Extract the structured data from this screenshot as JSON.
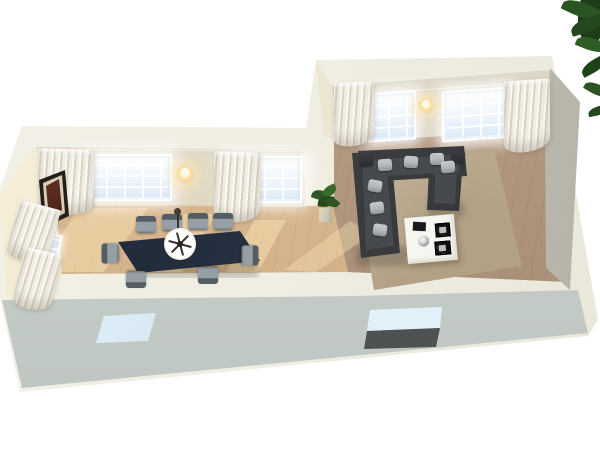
{
  "scene": {
    "type": "3d-floorplan-render",
    "description": "Isometric cutaway 3D render of an L-shaped open-plan apartment with a dining wing (left) and living wing (right)",
    "background": "#ffffff"
  },
  "colors": {
    "background": "#ffffff",
    "wall_top": "#efede1",
    "wall_face_north_left": "#ddd5c1",
    "wall_face_north_right": "#d5cebd",
    "wall_face_west": "#f1e8cd",
    "wall_face_east": "#c9c6bb",
    "wall_exterior_south": "#c8cfcb",
    "partition": "#f0eee2",
    "floor_dining": "#d8b68d",
    "floor_living": "#b29880",
    "sun_patch": "#f6e0b2",
    "window_glass": "#eef5fc",
    "window_frame": "#ffffff",
    "curtain_light": "#f1ede3",
    "curtain_shade": "#d9d3c6",
    "sconce_glow": "#ffd98f",
    "table": "#243040",
    "chair_seat": "#969fa6",
    "chair_back": "#555d64",
    "sofa": "#393b3e",
    "sofa_cushion": "#46494d",
    "pillow_light": "#b2b7bb",
    "pillow_dark": "#2c2e31",
    "rug": "#c6b59a",
    "coffee_table": "#f6f6f1",
    "decor_black": "#1a1b1d",
    "bowl": "#aeb2b5",
    "art_frame": "#221f1b",
    "art_canvas": "#55281e",
    "plant_leaf": "#2e5524",
    "plant_pot": "#cec7b2",
    "foreground_leaf": "#24471d",
    "south_window_glass": "#cfe4f0",
    "south_door_glass": "#dceef8",
    "south_door_panel": "#54575a"
  },
  "structure": {
    "wings": [
      {
        "name": "dining-wing",
        "north_windows": 2,
        "west_windows": 2,
        "sconces": 1,
        "wall_art": 1
      },
      {
        "name": "living-wing",
        "north_windows": 2,
        "sconces": 1
      }
    ],
    "south_openings": [
      "small-window",
      "glass-door"
    ],
    "curtain_count": 6
  },
  "furniture": {
    "dining_table": {
      "shape": "long rectangle",
      "finish": "dark navy wood"
    },
    "dining_chairs": {
      "count": 8,
      "finish": "gray upholstery"
    },
    "chandelier": {
      "style": "round white with dark spokes",
      "count": 1
    },
    "sofa": {
      "style": "U-shaped sectional",
      "finish": "charcoal",
      "light_pillows": 7,
      "dark_pillows": 2
    },
    "rug": {
      "style": "shaggy tan"
    },
    "coffee_table": {
      "finish": "white cube",
      "items": [
        "black book",
        "framed print",
        "framed print",
        "metal bowl"
      ]
    },
    "floor_plant": {
      "count": 1,
      "location": "partition-end"
    },
    "foreground_foliage": {
      "location": "top-right-corner"
    }
  }
}
